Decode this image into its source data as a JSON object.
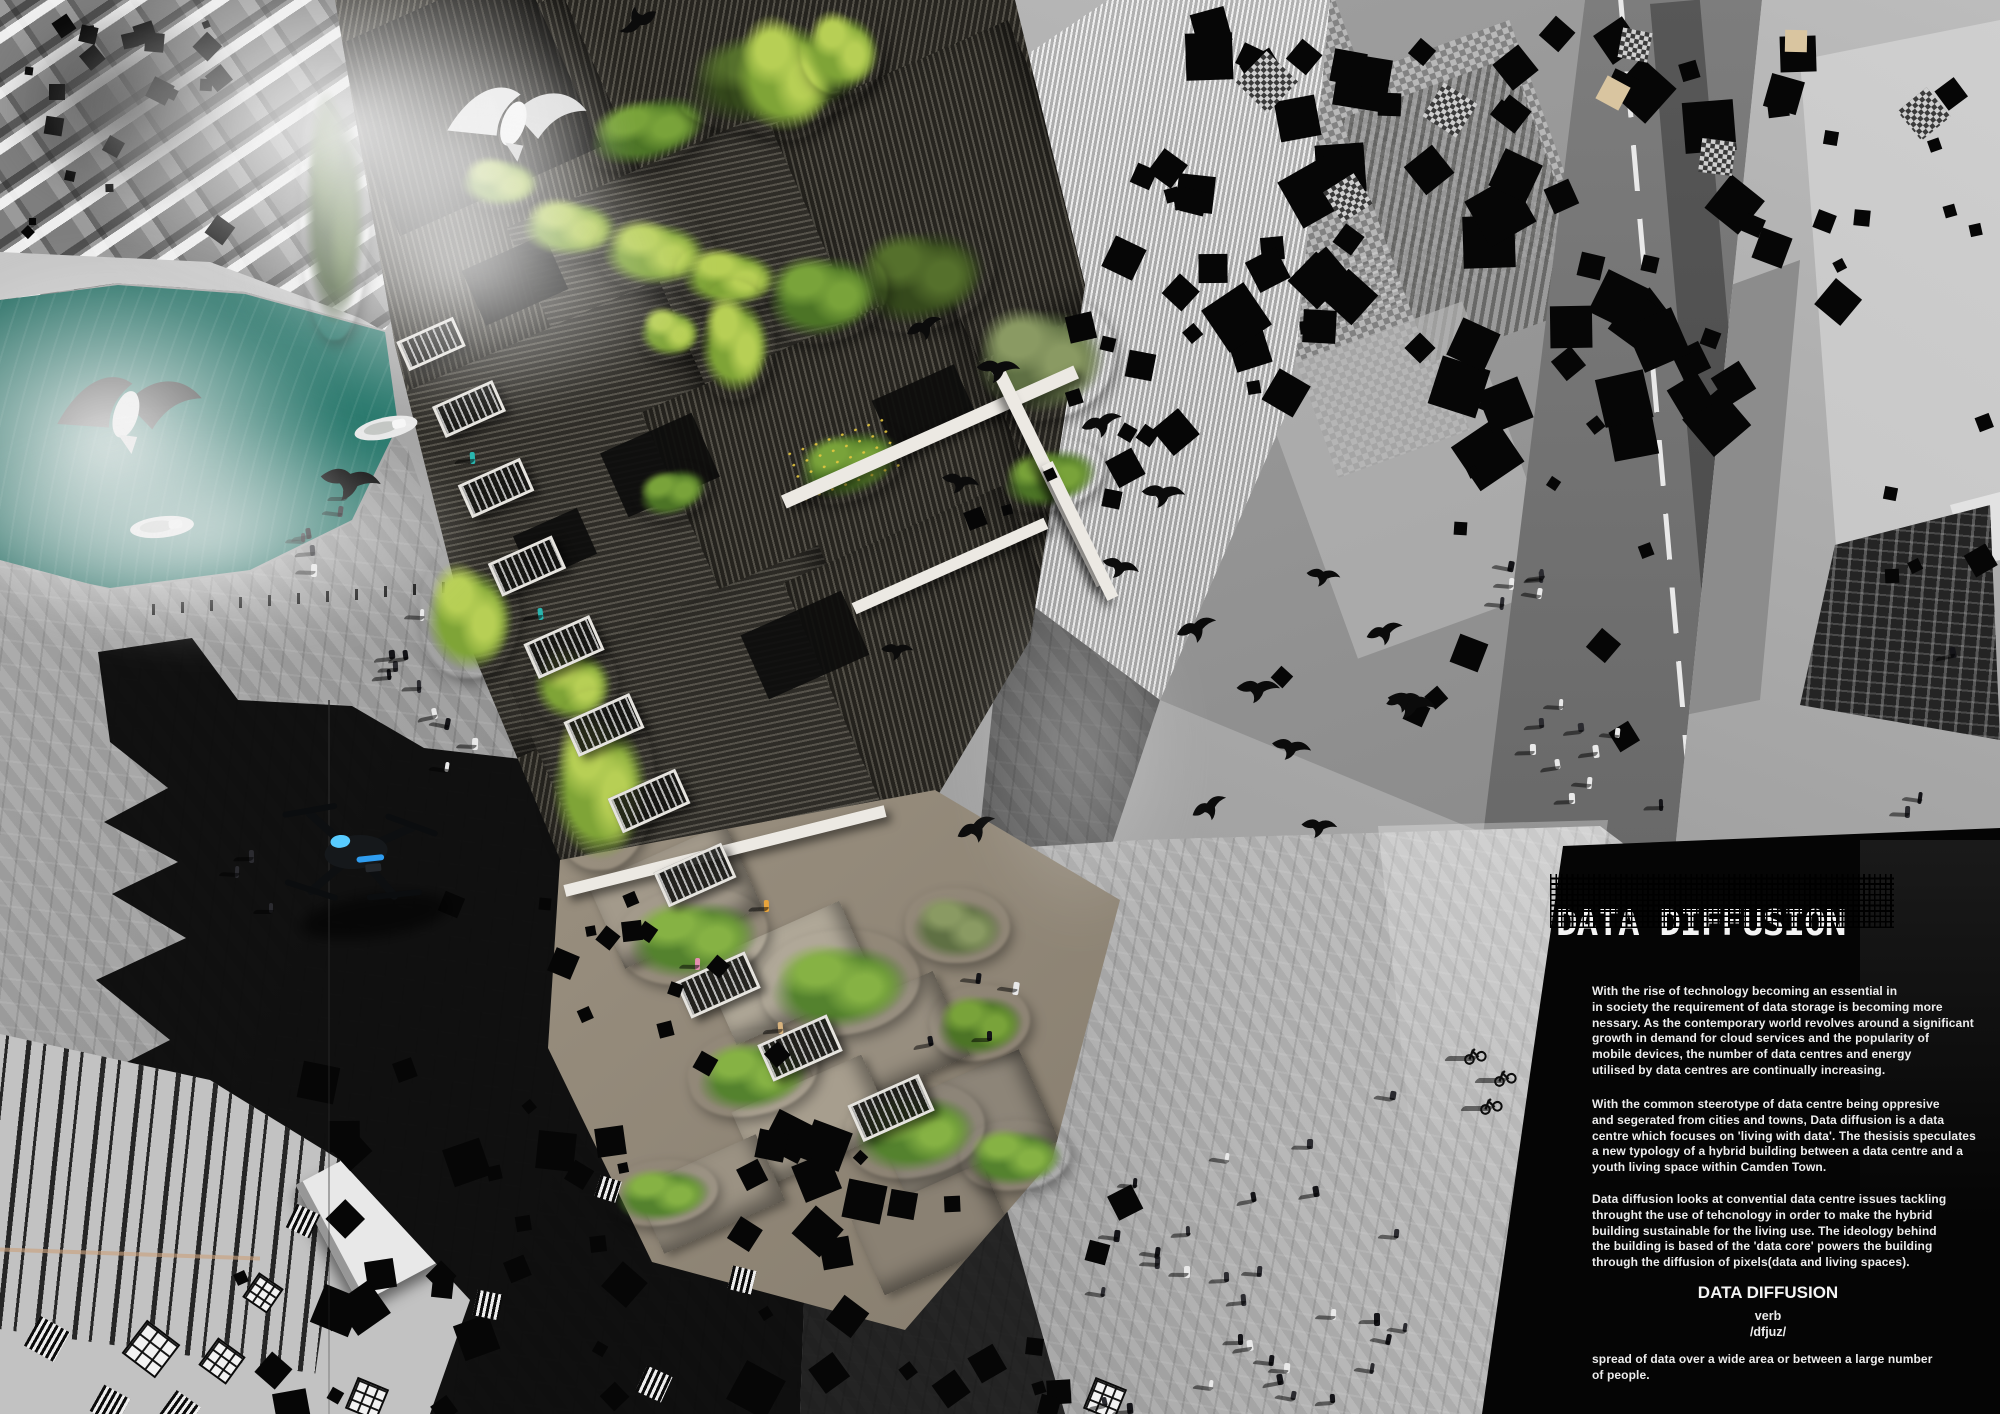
{
  "poster": {
    "title": "DATA DIFFUSION",
    "paragraphs": [
      "With the rise of technology becoming an essential in\nin society the requirement of data storage is becoming more\nnessary.  As the contemporary world revolves around a significant\ngrowth in demand for cloud services and the popularity of\nmobile devices, the number of data centres and energy\nutilised by data centres are continually increasing.",
      "With the common steerotype of data centre being oppresive\nand segerated from cities and towns, Data diffusion is a data\ncentre which focuses on 'living with data'. The thesisis speculates\na new typology of a hybrid building between a data centre and a\nyouth living space within Camden Town.",
      "Data diffusion looks at convential data centre issues tackling\nthrought the use of tehcnology in order to make the hybrid\nbuilding sustainable for the living use. The ideology behind\nthe building is based of the 'data core' powers the building\nthrough the diffusion of pixels(data and living spaces)."
    ],
    "definition": {
      "term": "DATA DIFFUSION",
      "part_of_speech": "verb",
      "pronunciation": "/dfjuz/",
      "meaning": "spread of data over a wide area or between a large number\nof people."
    }
  },
  "scene": {
    "icons": [
      "seagull-icon",
      "bird-icon",
      "drone-icon",
      "boat-icon",
      "pedestrian-icon",
      "cyclist-icon",
      "pixel-square"
    ],
    "colors": {
      "canal_water": "#17574e",
      "vegetation_bright": "#b7cf55",
      "vegetation_deep": "#4a6628",
      "building_dark": "#26241f",
      "drone_led": "#58cbff",
      "panel_black": "#050505",
      "text_white": "#ededed"
    }
  }
}
